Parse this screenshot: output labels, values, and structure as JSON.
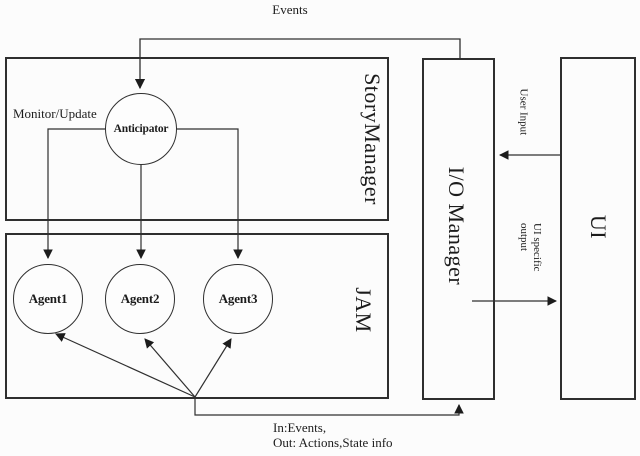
{
  "figure": {
    "labels": {
      "events": "Events",
      "monitor_update": "Monitor/Update",
      "user_input": "User Input",
      "ui_specific_line1": "UI specific",
      "ui_specific_line2": "output",
      "in_out_line1": "In:Events,",
      "in_out_line2": "Out: Actions,State info"
    },
    "containers": {
      "story_manager": "StoryManager",
      "jam": "JAM",
      "io_manager": "I/O Manager",
      "ui": "UI"
    },
    "nodes": {
      "anticipator": "Anticipator",
      "agent1": "Agent1",
      "agent2": "Agent2",
      "agent3": "Agent3"
    },
    "colors": {
      "line": "#2f2f2f",
      "text": "#1c1c1c",
      "background": "#fcfcfc"
    }
  }
}
